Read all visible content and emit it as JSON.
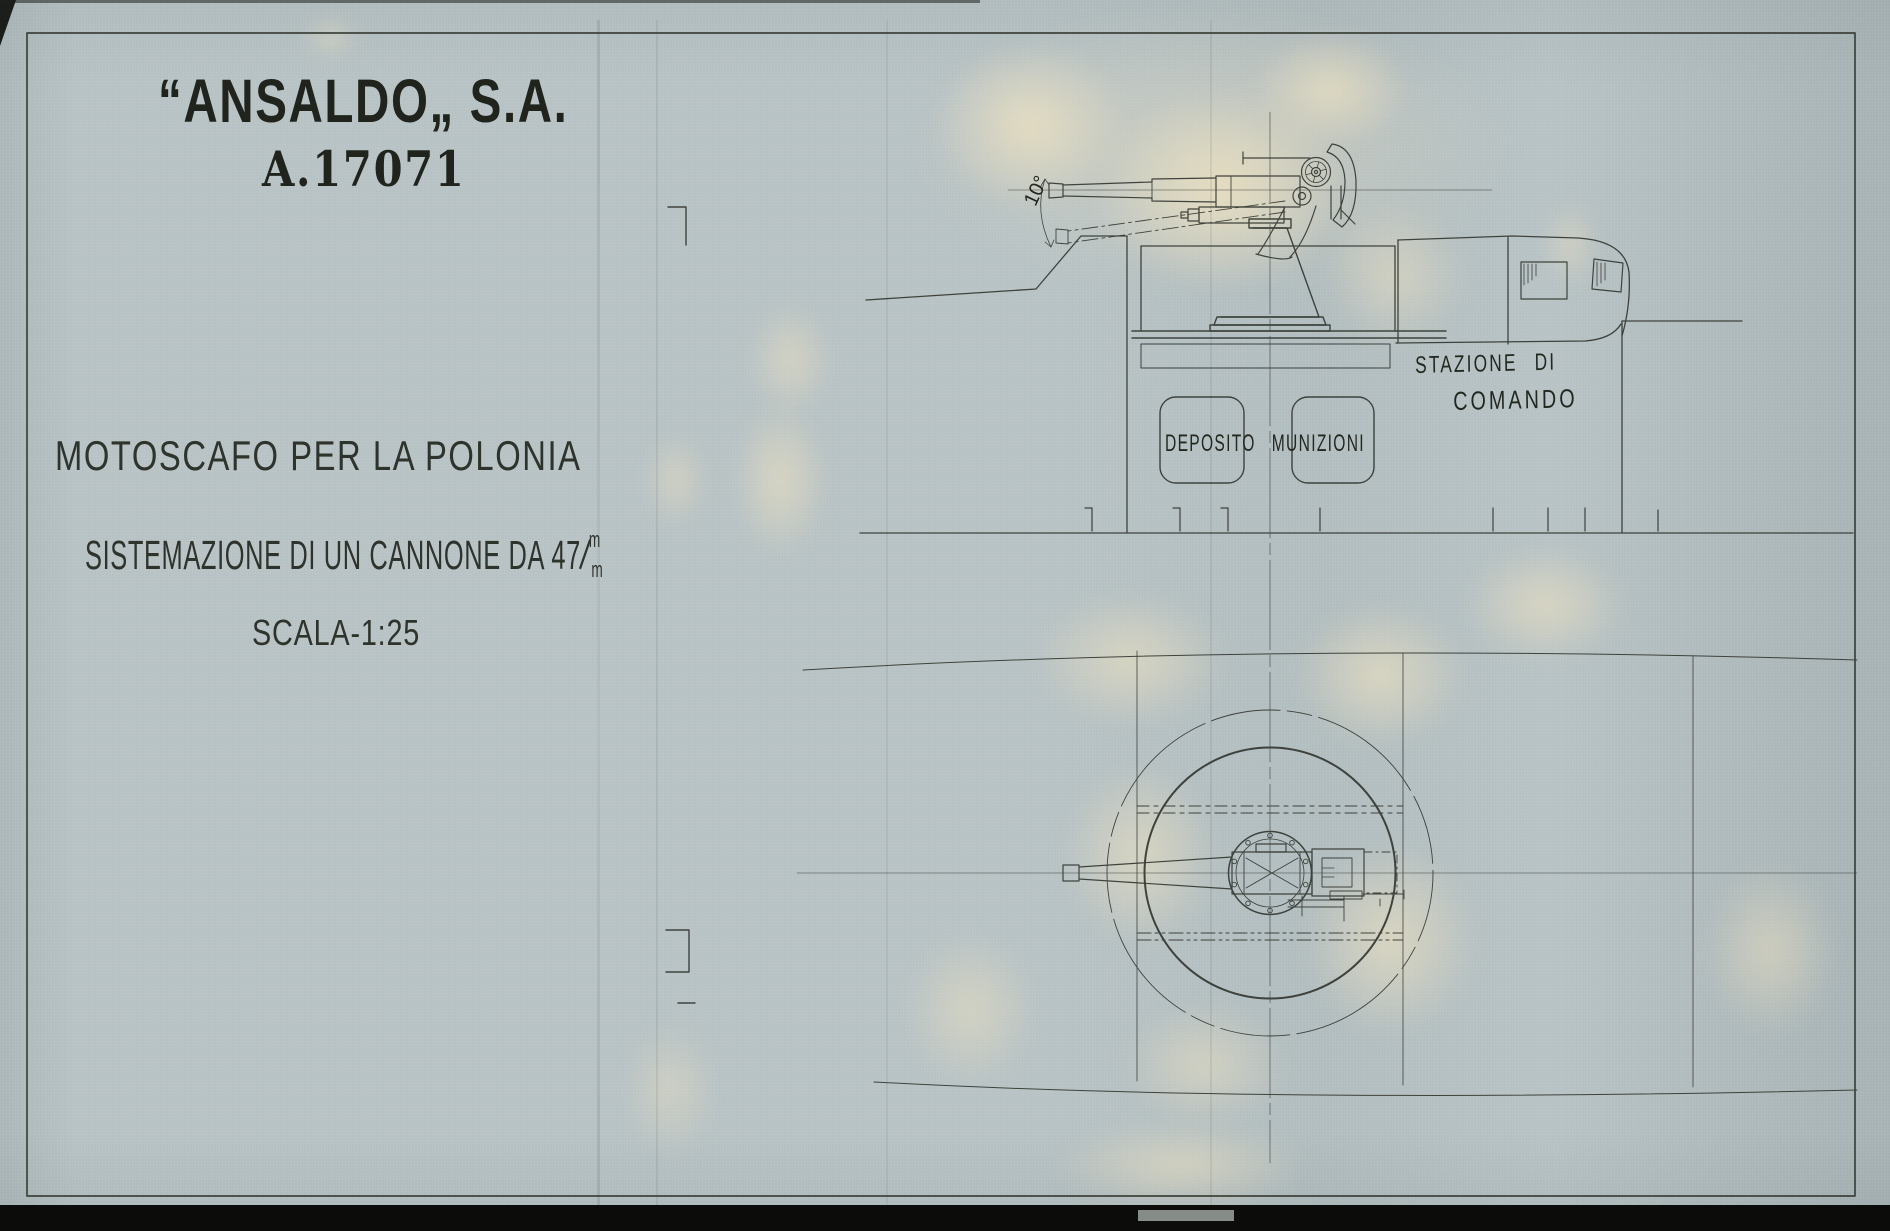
{
  "sheet": {
    "company": "“ANSALDO„ S.A.",
    "drawing_number": "A.17071",
    "title": "MOTOSCAFO PER LA POLONIA",
    "subtitle": "SISTEMAZIONE DI UN CANNONE DA 47",
    "caliber_fraction": {
      "top": "m",
      "separator": "/",
      "bottom": "m"
    },
    "scale": "SCALA-1:25"
  },
  "annotations": {
    "station_line1": "STAZIONE DI",
    "station_line2": "COMANDO",
    "ammo_depot": "DEPOSITO MUNIZIONI",
    "depression_angle": "10°"
  },
  "colors": {
    "fabric": "#b7c2c4",
    "ink": "#343831",
    "stencil_ink": "#20241d",
    "stain": "#eee2c1",
    "scan_edge": "#0c0d0a"
  }
}
